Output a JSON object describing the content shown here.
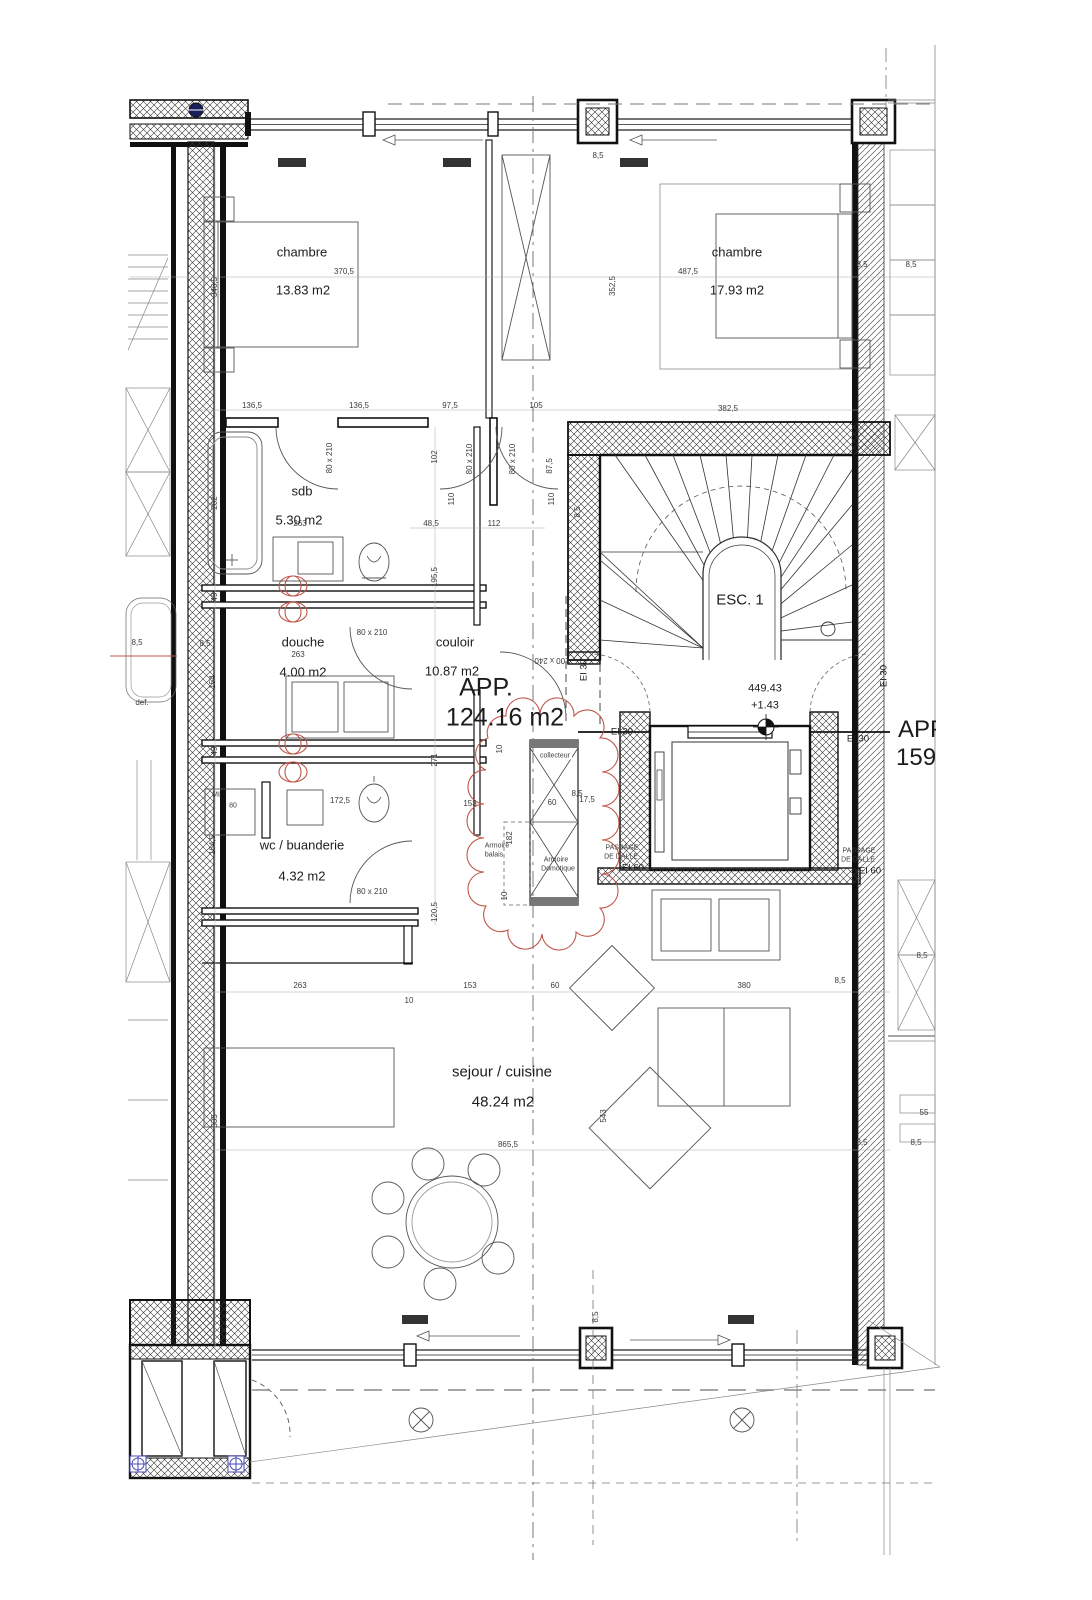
{
  "apartment": {
    "label": "APP.",
    "area": "124.16 m2"
  },
  "neighbor": {
    "label": "APP.",
    "area": "159."
  },
  "rooms": [
    {
      "name": "chambre",
      "area": "13.83 m2"
    },
    {
      "name": "chambre",
      "area": "17.93 m2"
    },
    {
      "name": "sdb",
      "area": "5.30 m2"
    },
    {
      "name": "douche",
      "area": "4.00 m2"
    },
    {
      "name": "couloir",
      "area": "10.87 m2"
    },
    {
      "name": "wc / buanderie",
      "area": "4.32 m2"
    },
    {
      "name": "sejour / cuisine",
      "area": "48.24 m2"
    },
    {
      "name": "ESC. 1"
    }
  ],
  "level": {
    "altitude": "449.43",
    "relative": "+1.43"
  },
  "fire": {
    "ei30": "EI 30",
    "passage1": "PASSAGE",
    "passage2": "DE DALLE",
    "ei60": "EI 60"
  },
  "doors": {
    "standard": "80 x 210",
    "entrance": "100 x 240"
  },
  "colors": {
    "revision_red": "#c0564a",
    "marker_blue": "#4a48b8",
    "line": "#222222"
  },
  "labels": [
    {
      "n": "room-label-chambre-1",
      "t": "chambre",
      "x": 302,
      "y": 252,
      "s": "m"
    },
    {
      "n": "room-area-chambre-1",
      "t": "13.83 m2",
      "x": 303,
      "y": 290,
      "s": "m"
    },
    {
      "n": "room-label-chambre-2",
      "t": "chambre",
      "x": 737,
      "y": 252,
      "s": "m"
    },
    {
      "n": "room-area-chambre-2",
      "t": "17.93 m2",
      "x": 737,
      "y": 290,
      "s": "m"
    },
    {
      "n": "room-label-sdb",
      "t": "sdb",
      "x": 302,
      "y": 491,
      "s": "m"
    },
    {
      "n": "room-area-sdb",
      "t": "5.30 m2",
      "x": 299,
      "y": 520,
      "s": "m"
    },
    {
      "n": "room-label-douche",
      "t": "douche",
      "x": 303,
      "y": 642,
      "s": "m"
    },
    {
      "n": "room-area-douche",
      "t": "4.00 m2",
      "x": 303,
      "y": 672,
      "s": "m"
    },
    {
      "n": "room-label-couloir",
      "t": "couloir",
      "x": 455,
      "y": 642,
      "s": "m"
    },
    {
      "n": "room-area-couloir",
      "t": "10.87 m2",
      "x": 452,
      "y": 671,
      "s": "m"
    },
    {
      "n": "apartment-label",
      "t": "APP.",
      "x": 486,
      "y": 688,
      "s": "xl"
    },
    {
      "n": "apartment-area",
      "t": "124.16 m2",
      "x": 505,
      "y": 718,
      "s": "xl"
    },
    {
      "n": "room-label-wc-buanderie",
      "t": "wc / buanderie",
      "x": 302,
      "y": 845,
      "s": "m"
    },
    {
      "n": "room-area-wc-buanderie",
      "t": "4.32 m2",
      "x": 302,
      "y": 876,
      "s": "m"
    },
    {
      "n": "room-label-sejour-cuisine",
      "t": "sejour / cuisine",
      "x": 502,
      "y": 1072,
      "s": "l"
    },
    {
      "n": "room-area-sejour-cuisine",
      "t": "48.24 m2",
      "x": 503,
      "y": 1102,
      "s": "l"
    },
    {
      "n": "stair-label",
      "t": "ESC. 1",
      "x": 740,
      "y": 600,
      "s": "l"
    },
    {
      "n": "level-altitude",
      "t": "449.43",
      "x": 765,
      "y": 689,
      "s": "lv"
    },
    {
      "n": "level-relative",
      "t": "+1.43",
      "x": 765,
      "y": 706,
      "s": "lv"
    },
    {
      "n": "door-size-label",
      "t": "80 x 210",
      "x": 330,
      "y": 458,
      "r": -90
    },
    {
      "n": "door-size-label",
      "t": "80 x 210",
      "x": 470,
      "y": 459,
      "r": -90
    },
    {
      "n": "door-size-label",
      "t": "80 x 210",
      "x": 513,
      "y": 459,
      "r": -90
    },
    {
      "n": "door-size-label",
      "t": "80 x 210",
      "x": 372,
      "y": 633
    },
    {
      "n": "door-size-label",
      "t": "80 x 210",
      "x": 372,
      "y": 892
    },
    {
      "n": "door-size-label",
      "t": "100 x 240",
      "x": 552,
      "y": 660,
      "r": 180
    },
    {
      "n": "fire-rating-label",
      "t": "EI 30",
      "x": 622,
      "y": 732,
      "s": "ei"
    },
    {
      "n": "fire-rating-label",
      "t": "EI 30",
      "x": 858,
      "y": 739,
      "s": "ei"
    },
    {
      "n": "fire-rating-label",
      "t": "EI 30",
      "x": 584,
      "y": 670,
      "r": -90,
      "s": "ei"
    },
    {
      "n": "fire-rating-label",
      "t": "EI 30",
      "x": 884,
      "y": 676,
      "r": -90,
      "s": "ei"
    },
    {
      "n": "fire-passage-label",
      "t": "PASSAGE",
      "x": 622,
      "y": 848,
      "s": "xs"
    },
    {
      "n": "fire-passage-label",
      "t": "DE DALLE",
      "x": 621,
      "y": 857,
      "s": "xs"
    },
    {
      "n": "fire-passage-label",
      "t": "EI 60",
      "x": 633,
      "y": 868,
      "s": "ei"
    },
    {
      "n": "fire-passage-label",
      "t": "PASSAGE",
      "x": 859,
      "y": 851,
      "s": "xs"
    },
    {
      "n": "fire-passage-label",
      "t": "DE DALLE",
      "x": 858,
      "y": 860,
      "s": "xs"
    },
    {
      "n": "fire-passage-label",
      "t": "EI 60",
      "x": 870,
      "y": 871,
      "s": "ei"
    },
    {
      "n": "collecteur-label",
      "t": "collecteur",
      "x": 555,
      "y": 756,
      "s": "xs",
      "c": "bg"
    },
    {
      "n": "armoire-balais-label",
      "t": "Armoire",
      "x": 497,
      "y": 846,
      "s": "xs"
    },
    {
      "n": "armoire-balais-label",
      "t": "balais",
      "x": 494,
      "y": 855,
      "s": "xs"
    },
    {
      "n": "armoire-domotique-label",
      "t": "Armoire",
      "x": 556,
      "y": 860,
      "s": "xs"
    },
    {
      "n": "armoire-domotique-label",
      "t": "Domotique",
      "x": 558,
      "y": 869,
      "s": "xs"
    },
    {
      "n": "ml-label",
      "t": "ML",
      "x": 217,
      "y": 795,
      "s": "xs"
    },
    {
      "n": "dim-label",
      "t": "80",
      "x": 233,
      "y": 806,
      "s": "xs"
    },
    {
      "n": "def-label",
      "t": "def.",
      "x": 142,
      "y": 703
    },
    {
      "n": "dim-label",
      "t": "370,5",
      "x": 344,
      "y": 272
    },
    {
      "n": "dim-label",
      "t": "346,5",
      "x": 215,
      "y": 287,
      "r": -90
    },
    {
      "n": "dim-label",
      "t": "487,5",
      "x": 688,
      "y": 272
    },
    {
      "n": "dim-label",
      "t": "352,5",
      "x": 613,
      "y": 286,
      "r": -90
    },
    {
      "n": "dim-label",
      "t": "8,5",
      "x": 862,
      "y": 265
    },
    {
      "n": "dim-label",
      "t": "8,5",
      "x": 911,
      "y": 265
    },
    {
      "n": "dim-label",
      "t": "382,5",
      "x": 728,
      "y": 409
    },
    {
      "n": "dim-label",
      "t": "136,5",
      "x": 252,
      "y": 406
    },
    {
      "n": "dim-label",
      "t": "136,5",
      "x": 359,
      "y": 406
    },
    {
      "n": "dim-label",
      "t": "97,5",
      "x": 450,
      "y": 406
    },
    {
      "n": "dim-label",
      "t": "105",
      "x": 536,
      "y": 406
    },
    {
      "n": "dim-label",
      "t": "8,5",
      "x": 598,
      "y": 156
    },
    {
      "n": "dim-label",
      "t": "102",
      "x": 435,
      "y": 457,
      "r": -90
    },
    {
      "n": "dim-label",
      "t": "110",
      "x": 452,
      "y": 499,
      "r": -90
    },
    {
      "n": "dim-label",
      "t": "110",
      "x": 552,
      "y": 499,
      "r": -90
    },
    {
      "n": "dim-label",
      "t": "87,5",
      "x": 550,
      "y": 466,
      "r": -90
    },
    {
      "n": "dim-label",
      "t": "48,5",
      "x": 431,
      "y": 524
    },
    {
      "n": "dim-label",
      "t": "112",
      "x": 494,
      "y": 524
    },
    {
      "n": "dim-label",
      "t": "263",
      "x": 300,
      "y": 524
    },
    {
      "n": "dim-label",
      "t": "202",
      "x": 215,
      "y": 503,
      "r": -90
    },
    {
      "n": "dim-label",
      "t": "195,5",
      "x": 435,
      "y": 577,
      "r": -90
    },
    {
      "n": "dim-label",
      "t": "49",
      "x": 215,
      "y": 597,
      "r": -90
    },
    {
      "n": "dim-label",
      "t": "8,5",
      "x": 205,
      "y": 644
    },
    {
      "n": "dim-label",
      "t": "8,5",
      "x": 137,
      "y": 643
    },
    {
      "n": "dim-label",
      "t": "263",
      "x": 298,
      "y": 655
    },
    {
      "n": "dim-label",
      "t": "154",
      "x": 213,
      "y": 682,
      "r": -90
    },
    {
      "n": "dim-label",
      "t": "271",
      "x": 435,
      "y": 760,
      "r": -90
    },
    {
      "n": "dim-label",
      "t": "49",
      "x": 215,
      "y": 751,
      "r": -90
    },
    {
      "n": "dim-label",
      "t": "164,5",
      "x": 213,
      "y": 845,
      "r": -90
    },
    {
      "n": "dim-label",
      "t": "172,5",
      "x": 340,
      "y": 801
    },
    {
      "n": "dim-label",
      "t": "120,5",
      "x": 435,
      "y": 912,
      "r": -90
    },
    {
      "n": "dim-label",
      "t": "153",
      "x": 470,
      "y": 804
    },
    {
      "n": "dim-label",
      "t": "60",
      "x": 552,
      "y": 803
    },
    {
      "n": "dim-label",
      "t": "8,5",
      "x": 577,
      "y": 794
    },
    {
      "n": "dim-label",
      "t": "17,5",
      "x": 587,
      "y": 800
    },
    {
      "n": "dim-label",
      "t": "10",
      "x": 500,
      "y": 749,
      "r": -90
    },
    {
      "n": "dim-label",
      "t": "182",
      "x": 510,
      "y": 838,
      "r": -90
    },
    {
      "n": "dim-label",
      "t": "10",
      "x": 505,
      "y": 896,
      "r": -90
    },
    {
      "n": "dim-label",
      "t": "263",
      "x": 300,
      "y": 986
    },
    {
      "n": "dim-label",
      "t": "153",
      "x": 470,
      "y": 986
    },
    {
      "n": "dim-label",
      "t": "60",
      "x": 555,
      "y": 986
    },
    {
      "n": "dim-label",
      "t": "380",
      "x": 744,
      "y": 986
    },
    {
      "n": "dim-label",
      "t": "8,5",
      "x": 840,
      "y": 981
    },
    {
      "n": "dim-label",
      "t": "10",
      "x": 409,
      "y": 1001
    },
    {
      "n": "dim-label",
      "t": "535",
      "x": 215,
      "y": 1121,
      "r": -90
    },
    {
      "n": "dim-label",
      "t": "865,5",
      "x": 508,
      "y": 1145
    },
    {
      "n": "dim-label",
      "t": "543",
      "x": 604,
      "y": 1116,
      "r": -90
    },
    {
      "n": "dim-label",
      "t": "8,5",
      "x": 922,
      "y": 956
    },
    {
      "n": "dim-label",
      "t": "55",
      "x": 924,
      "y": 1113
    },
    {
      "n": "dim-label",
      "t": "8,5",
      "x": 916,
      "y": 1143
    },
    {
      "n": "dim-label",
      "t": "8,5",
      "x": 862,
      "y": 1143
    },
    {
      "n": "dim-label",
      "t": "8,5",
      "x": 596,
      "y": 1317,
      "r": -90
    },
    {
      "n": "dim-label",
      "t": "8,5",
      "x": 578,
      "y": 512,
      "r": -90
    }
  ]
}
